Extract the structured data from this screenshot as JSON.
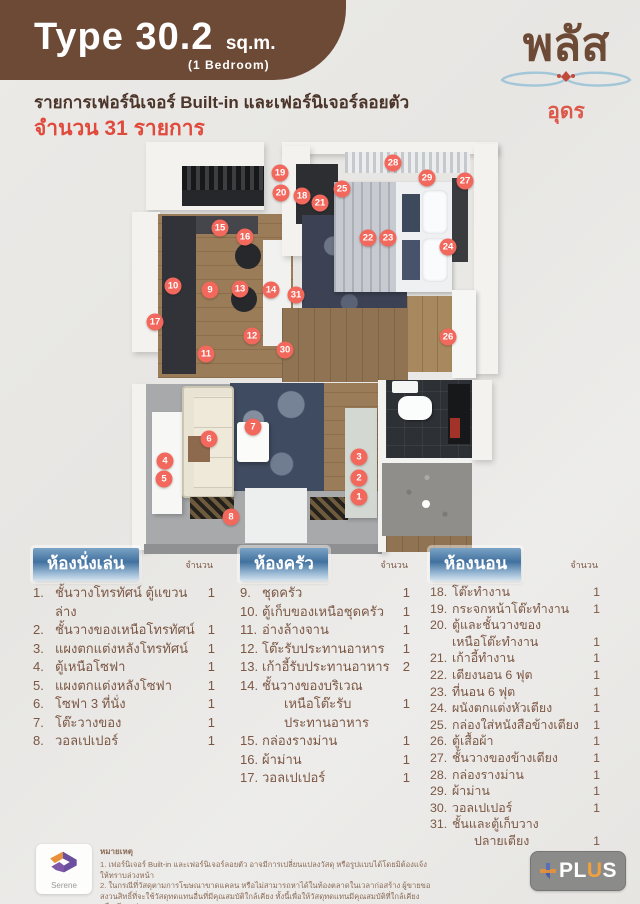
{
  "header": {
    "type_label": "Type 30.2",
    "unit_label": "sq.m.",
    "bedroom_label": "(1 Bedroom)",
    "list_title": "รายการเฟอร์นิเจอร์ Built-in และเฟอร์นิเจอร์ลอยตัว",
    "count_line": "จำนวน 31 รายการ"
  },
  "brand": {
    "name": "พลัส",
    "location": "อุดร"
  },
  "colors": {
    "header_brown": "#6d4a36",
    "accent_red": "#e04a3c",
    "marker_red": "#f2685c",
    "bar_blue": "#41719f",
    "list_text_brown": "#7b5744"
  },
  "floorplan": {
    "markers": [
      {
        "n": "1",
        "x": 229,
        "y": 357
      },
      {
        "n": "2",
        "x": 229,
        "y": 338
      },
      {
        "n": "3",
        "x": 229,
        "y": 317
      },
      {
        "n": "4",
        "x": 35,
        "y": 321
      },
      {
        "n": "5",
        "x": 34,
        "y": 339
      },
      {
        "n": "6",
        "x": 79,
        "y": 299
      },
      {
        "n": "7",
        "x": 123,
        "y": 287
      },
      {
        "n": "8",
        "x": 101,
        "y": 377
      },
      {
        "n": "9",
        "x": 80,
        "y": 150
      },
      {
        "n": "10",
        "x": 43,
        "y": 146
      },
      {
        "n": "11",
        "x": 76,
        "y": 214
      },
      {
        "n": "12",
        "x": 122,
        "y": 196
      },
      {
        "n": "13",
        "x": 110,
        "y": 149
      },
      {
        "n": "14",
        "x": 141,
        "y": 150
      },
      {
        "n": "15",
        "x": 90,
        "y": 88
      },
      {
        "n": "16",
        "x": 115,
        "y": 97
      },
      {
        "n": "17",
        "x": 25,
        "y": 182
      },
      {
        "n": "18",
        "x": 172,
        "y": 56
      },
      {
        "n": "19",
        "x": 150,
        "y": 33
      },
      {
        "n": "20",
        "x": 151,
        "y": 53
      },
      {
        "n": "21",
        "x": 190,
        "y": 63
      },
      {
        "n": "22",
        "x": 238,
        "y": 98
      },
      {
        "n": "23",
        "x": 258,
        "y": 98
      },
      {
        "n": "24",
        "x": 318,
        "y": 107
      },
      {
        "n": "25",
        "x": 212,
        "y": 49
      },
      {
        "n": "26",
        "x": 318,
        "y": 197
      },
      {
        "n": "27",
        "x": 335,
        "y": 41
      },
      {
        "n": "28",
        "x": 263,
        "y": 23
      },
      {
        "n": "29",
        "x": 297,
        "y": 38
      },
      {
        "n": "30",
        "x": 155,
        "y": 210
      },
      {
        "n": "31",
        "x": 166,
        "y": 155
      }
    ]
  },
  "columns": [
    {
      "title": "ห้องนั่งเล่น",
      "qty_header": "จำนวน",
      "items": [
        {
          "no": "1.",
          "text": "ชั้นวางโทรทัศน์ ตู้แขวนล่าง",
          "qty": "1"
        },
        {
          "no": "2.",
          "text": "ชั้นวางของเหนือโทรทัศน์",
          "qty": "1"
        },
        {
          "no": "3.",
          "text": "แผงตกแต่งหลังโทรทัศน์",
          "qty": "1"
        },
        {
          "no": "4.",
          "text": "ตู้เหนือโซฟา",
          "qty": "1"
        },
        {
          "no": "5.",
          "text": "แผงตกแต่งหลังโซฟา",
          "qty": "1"
        },
        {
          "no": "6.",
          "text": "โซฟา 3 ที่นั่ง",
          "qty": "1"
        },
        {
          "no": "7.",
          "text": "โต๊ะวางของ",
          "qty": "1"
        },
        {
          "no": "8.",
          "text": "วอลเปเปอร์",
          "qty": "1"
        }
      ]
    },
    {
      "title": "ห้องครัว",
      "qty_header": "จำนวน",
      "items": [
        {
          "no": "9.",
          "text": "ชุดครัว",
          "qty": "1"
        },
        {
          "no": "10.",
          "text": "ตู้เก็บของเหนือชุดครัว",
          "qty": "1"
        },
        {
          "no": "11.",
          "text": "อ่างล้างจาน",
          "qty": "1"
        },
        {
          "no": "12.",
          "text": "โต๊ะรับประทานอาหาร",
          "qty": "1"
        },
        {
          "no": "13.",
          "text": "เก้าอี้รับประทานอาหาร",
          "qty": "2"
        },
        {
          "no": "14.",
          "text": "ชั้นวางของบริเวณ",
          "text2": "เหนือโต๊ะรับประทานอาหาร",
          "indent2": true,
          "qty": "1"
        },
        {
          "no": "15.",
          "text": "กล่องรางม่าน",
          "qty": "1"
        },
        {
          "no": "16.",
          "text": "ผ้าม่าน",
          "qty": "1"
        },
        {
          "no": "17.",
          "text": "วอลเปเปอร์",
          "qty": "1"
        }
      ]
    },
    {
      "title": "ห้องนอน",
      "qty_header": "จำนวน",
      "items": [
        {
          "no": "18.",
          "text": "โต๊ะทำงาน",
          "qty": "1"
        },
        {
          "no": "19.",
          "text": "กระจกหน้าโต๊ะทำงาน",
          "qty": "1"
        },
        {
          "no": "20.",
          "text": "ตู้และชั้นวางของ",
          "text2": "เหนือโต๊ะทำงาน",
          "indent2": false,
          "qty": "1"
        },
        {
          "no": "21.",
          "text": "เก้าอี้ทำงาน",
          "qty": "1"
        },
        {
          "no": "22.",
          "text": "เตียงนอน 6 ฟุต",
          "qty": "1"
        },
        {
          "no": "23.",
          "text": "ที่นอน 6 ฟุต",
          "qty": "1"
        },
        {
          "no": "24.",
          "text": "ผนังตกแต่งหัวเตียง",
          "qty": "1"
        },
        {
          "no": "25.",
          "text": "กล่องใส่หนังสือข้างเตียง",
          "qty": "1"
        },
        {
          "no": "26.",
          "text": "ตู้เสื้อผ้า",
          "qty": "1"
        },
        {
          "no": "27.",
          "text": "ชั้นวางของข้างเตียง",
          "qty": "1"
        },
        {
          "no": "28.",
          "text": "กล่องรางม่าน",
          "qty": "1"
        },
        {
          "no": "29.",
          "text": "ผ้าม่าน",
          "qty": "1"
        },
        {
          "no": "30.",
          "text": "วอลเปเปอร์",
          "qty": "1"
        },
        {
          "no": "31.",
          "text": "ชั้นและตู้เก็บวาง",
          "text2": "ปลายเตียง",
          "indent2": true,
          "qty": "1"
        }
      ]
    }
  ],
  "footer": {
    "note_title": "หมายเหตุ",
    "notes": [
      "1. เฟอร์นิเจอร์ Built-in และเฟอร์นิเจอร์ลอยตัว อาจมีการเปลี่ยนแปลงวัสดุ หรือรูปแบบได้โดยมิต้องแจ้งให้ทราบล่วงหน้า",
      "2. ในกรณีที่วัสดุตามการโฆษณาขาดแคลน หรือไม่สามารถหาได้ในท้องตลาดในเวลาก่อสร้าง ผู้ขายขอสงวนสิทธิ์ที่จะใช้วัสดุทดแทนอื่นที่มีคุณสมบัติใกล้เคียง ทั้งนี้เพื่อให้วัสดุทดแทนมีคุณสมบัติที่ใกล้เคียง หรือเทียบเท่า"
    ],
    "serene_label": "Serene",
    "plus_label_white1": "PL",
    "plus_label_orange": "U",
    "plus_label_white2": "S"
  }
}
